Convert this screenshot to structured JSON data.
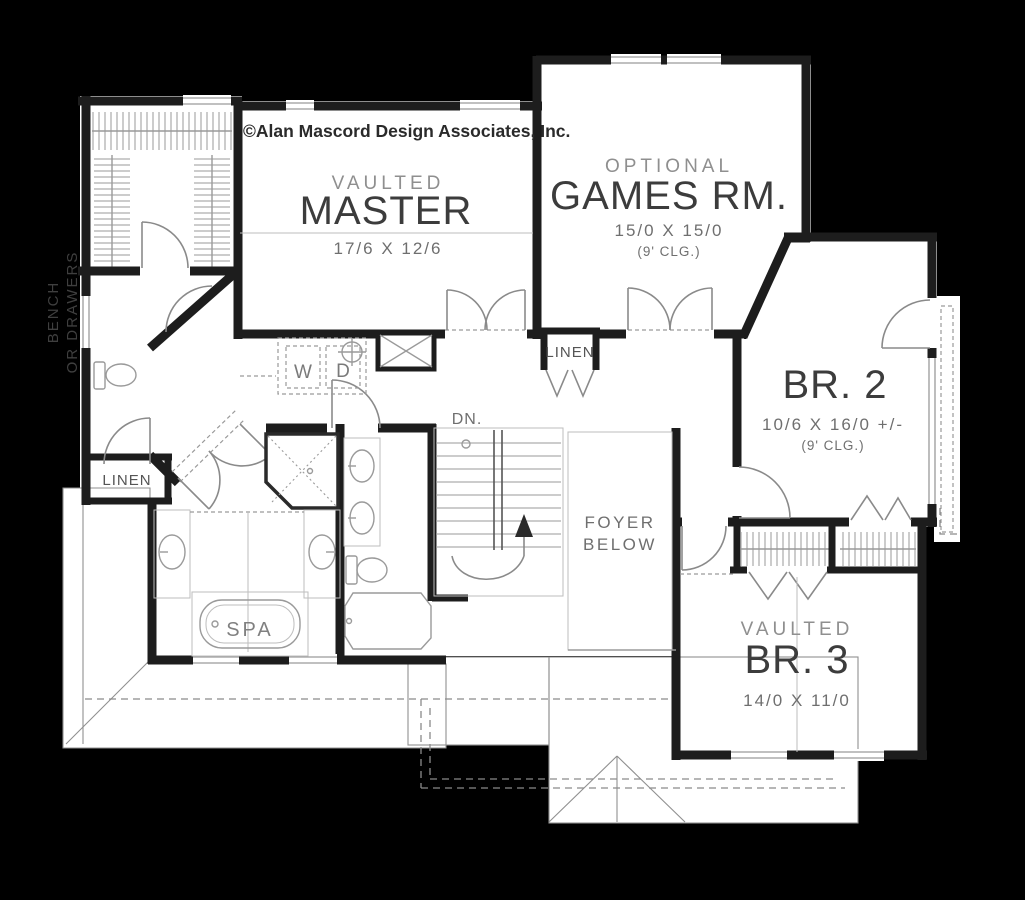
{
  "plan": {
    "copyright": "©Alan Mascord Design Associates, Inc.",
    "rooms": {
      "master": {
        "prefix": "VAULTED",
        "name": "MASTER",
        "dims": "17/6 X 12/6"
      },
      "games": {
        "prefix": "OPTIONAL",
        "name": "GAMES RM.",
        "dims": "15/0 X 15/0",
        "ceiling": "(9' CLG.)"
      },
      "br2": {
        "name": "BR. 2",
        "dims": "10/6 X 16/0 +/-",
        "ceiling": "(9' CLG.)"
      },
      "br3": {
        "prefix": "VAULTED",
        "name": "BR. 3",
        "dims": "14/0 X 11/0"
      },
      "foyer": {
        "line1": "FOYER",
        "line2": "BELOW"
      }
    },
    "labels": {
      "linen_hall": "LINEN",
      "linen_bath": "LINEN",
      "stairs_down": "DN.",
      "spa": "SPA",
      "washer": "W",
      "dryer": "D",
      "closet_note_line1": "BENCH",
      "closet_note_line2": "OR DRAWERS"
    },
    "colors": {
      "background": "#000000",
      "wall": "#1d1d1d",
      "floor": "#ffffff",
      "text_dark": "#3c3c3c",
      "text_medium": "#6f6f6f",
      "text_light": "#8f8f8f",
      "fixture_line": "#9a9a9a"
    }
  }
}
